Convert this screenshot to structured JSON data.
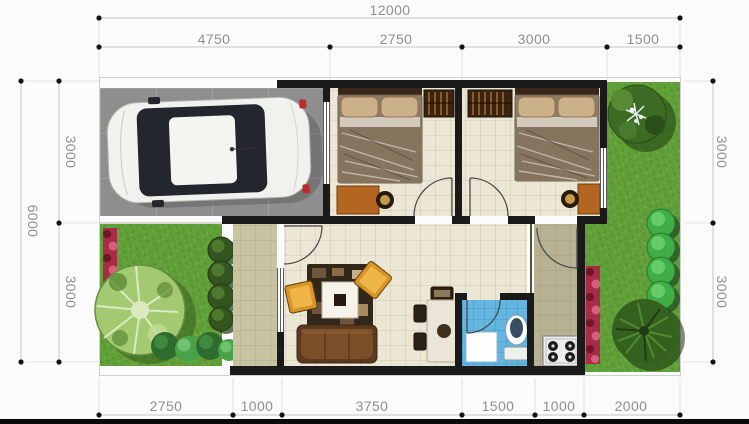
{
  "drawing_type": "house-floor-plan",
  "dimensions": {
    "top_total": "12000",
    "top": [
      "4750",
      "2750",
      "3000",
      "1500"
    ],
    "bottom": [
      "2750",
      "1000",
      "3750",
      "1500",
      "1000",
      "2000"
    ],
    "left_total": "6000",
    "left": [
      "3000",
      "3000"
    ],
    "right": [
      "3000",
      "3000"
    ]
  },
  "colors": {
    "paper": "#fbfbfb",
    "wall": "#1a1a1a",
    "floor": "#ece7d5",
    "floorGrid": "#cfc9ae",
    "terrace": "#c8c3a1",
    "terraceGrid": "#b0aa86",
    "kitchen": "#b8b294",
    "kitchenGrid": "#a39d80",
    "bathroom": "#64b5e0",
    "bathroomGrid": "#4496c6",
    "carport": "#8e8e8e",
    "carportGrid": "#a3a3a3",
    "grass": "#61a039",
    "flowers": "#a82c48",
    "wood": "#b4651f",
    "woodDark": "#3a2310",
    "sofa": "#5d3a1f",
    "cushion": "#d99427",
    "dimLine": "#c4c4c4",
    "dimText": "#8f8f8f"
  }
}
